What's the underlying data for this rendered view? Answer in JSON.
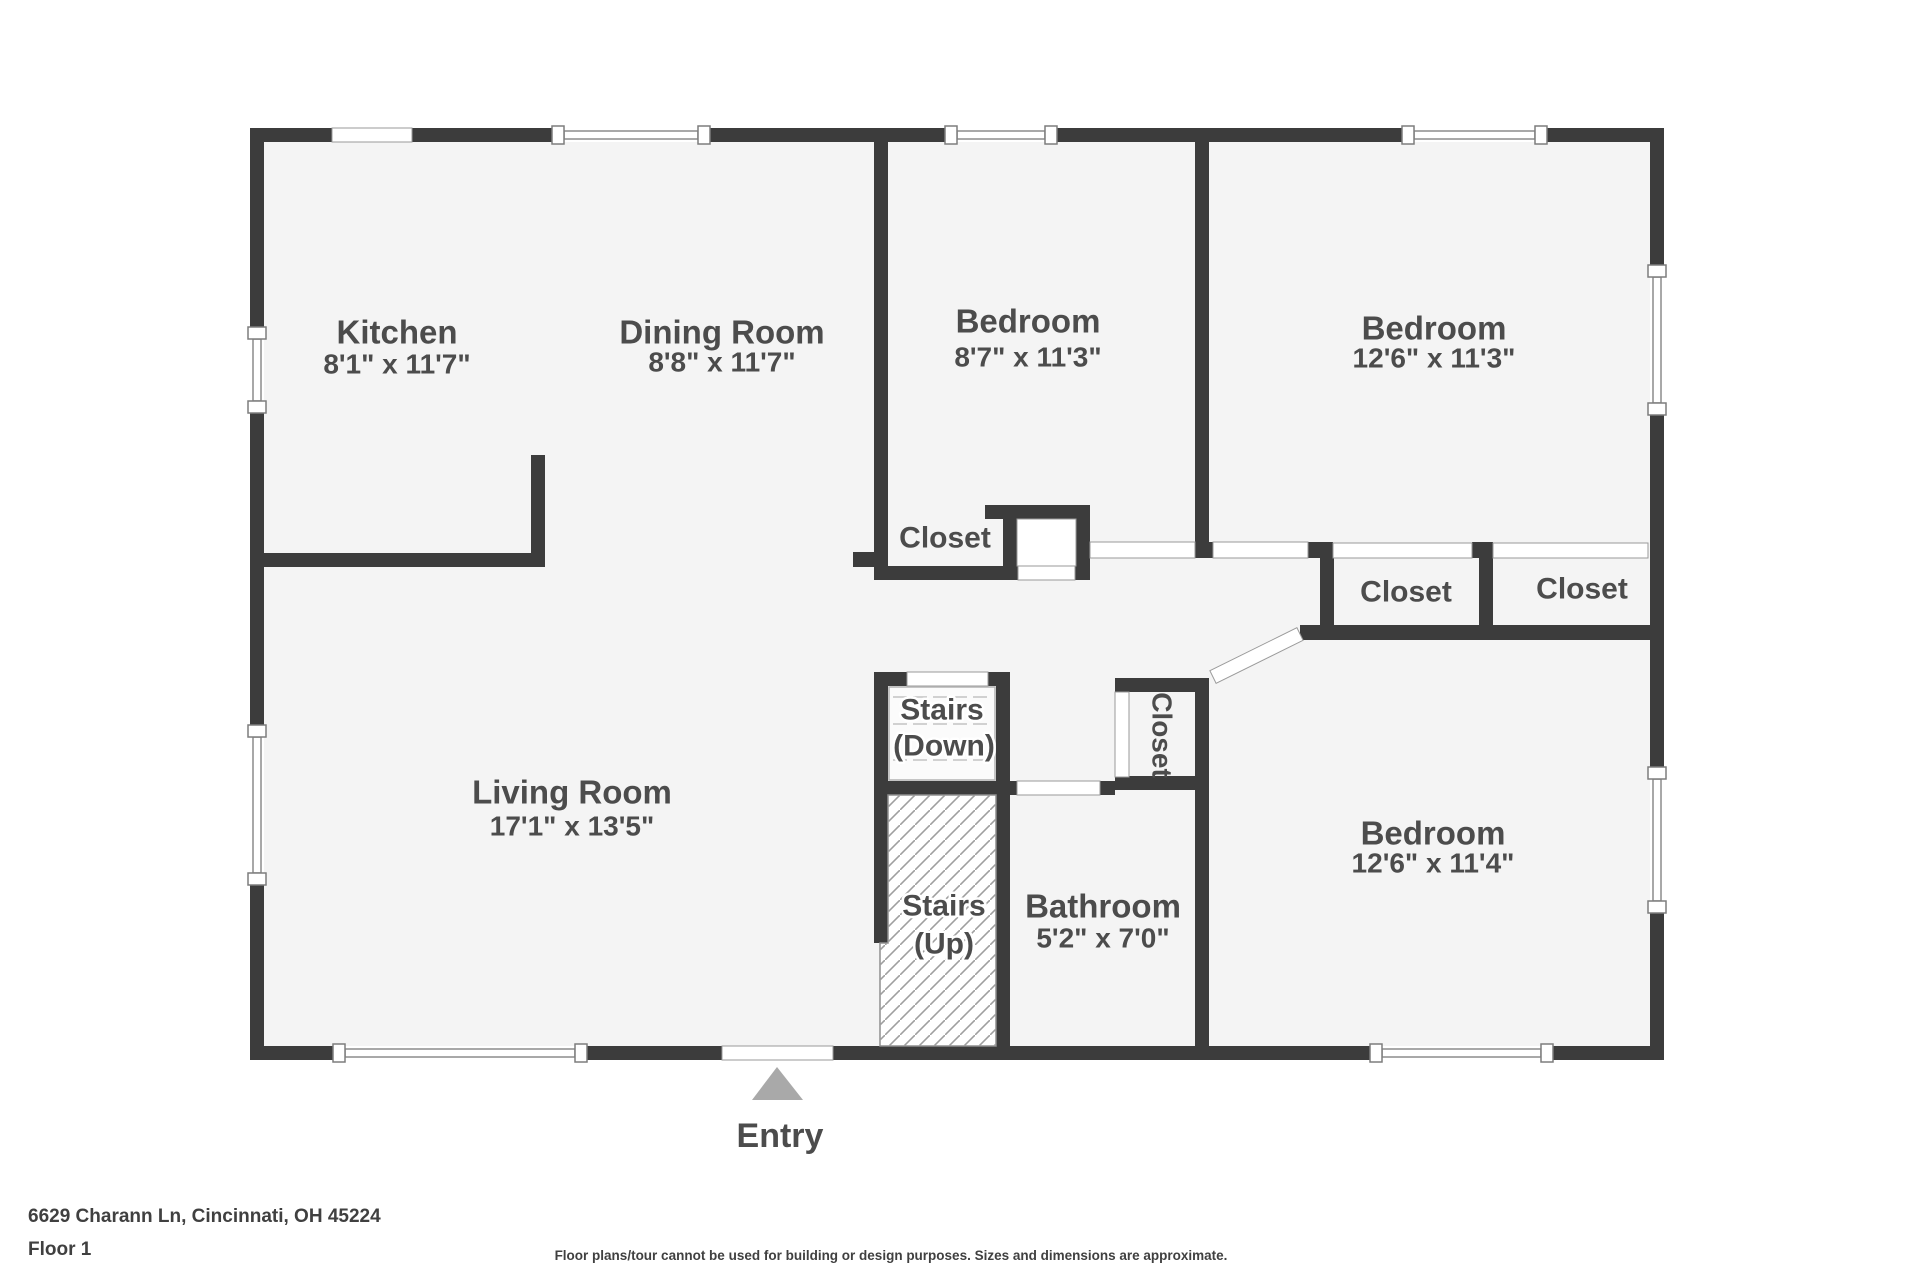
{
  "floorplan": {
    "colors": {
      "wall": "#3c3c3c",
      "floor": "#f4f4f4",
      "label_text": "#4c4c4c",
      "entry_arrow": "#a9a9a9"
    },
    "rooms": {
      "kitchen": {
        "name": "Kitchen",
        "dims": "8'1\" x 11'7\""
      },
      "dining": {
        "name": "Dining Room",
        "dims": "8'8\" x 11'7\""
      },
      "bedroom_top_middle": {
        "name": "Bedroom",
        "dims": "8'7\" x 11'3\""
      },
      "bedroom_top_right": {
        "name": "Bedroom",
        "dims": "12'6\" x 11'3\""
      },
      "living": {
        "name": "Living Room",
        "dims": "17'1\" x 13'5\""
      },
      "bathroom": {
        "name": "Bathroom",
        "dims": "5'2\" x 7'0\""
      },
      "bedroom_bottom_right": {
        "name": "Bedroom",
        "dims": "12'6\" x 11'4\""
      }
    },
    "closets": {
      "bedroom1_closet": "Closet",
      "left_closet": "Closet",
      "right_closet": "Closet",
      "hall_closet": "Closet"
    },
    "stairs": {
      "down_line1": "Stairs",
      "down_line2": "(Down)",
      "up_line1": "Stairs",
      "up_line2": "(Up)"
    },
    "entry": {
      "label": "Entry"
    }
  },
  "footer": {
    "address": "6629 Charann Ln, Cincinnati, OH 45224",
    "floor_label": "Floor 1",
    "disclaimer": "Floor plans/tour cannot be used for building or design purposes. Sizes and dimensions are approximate."
  }
}
